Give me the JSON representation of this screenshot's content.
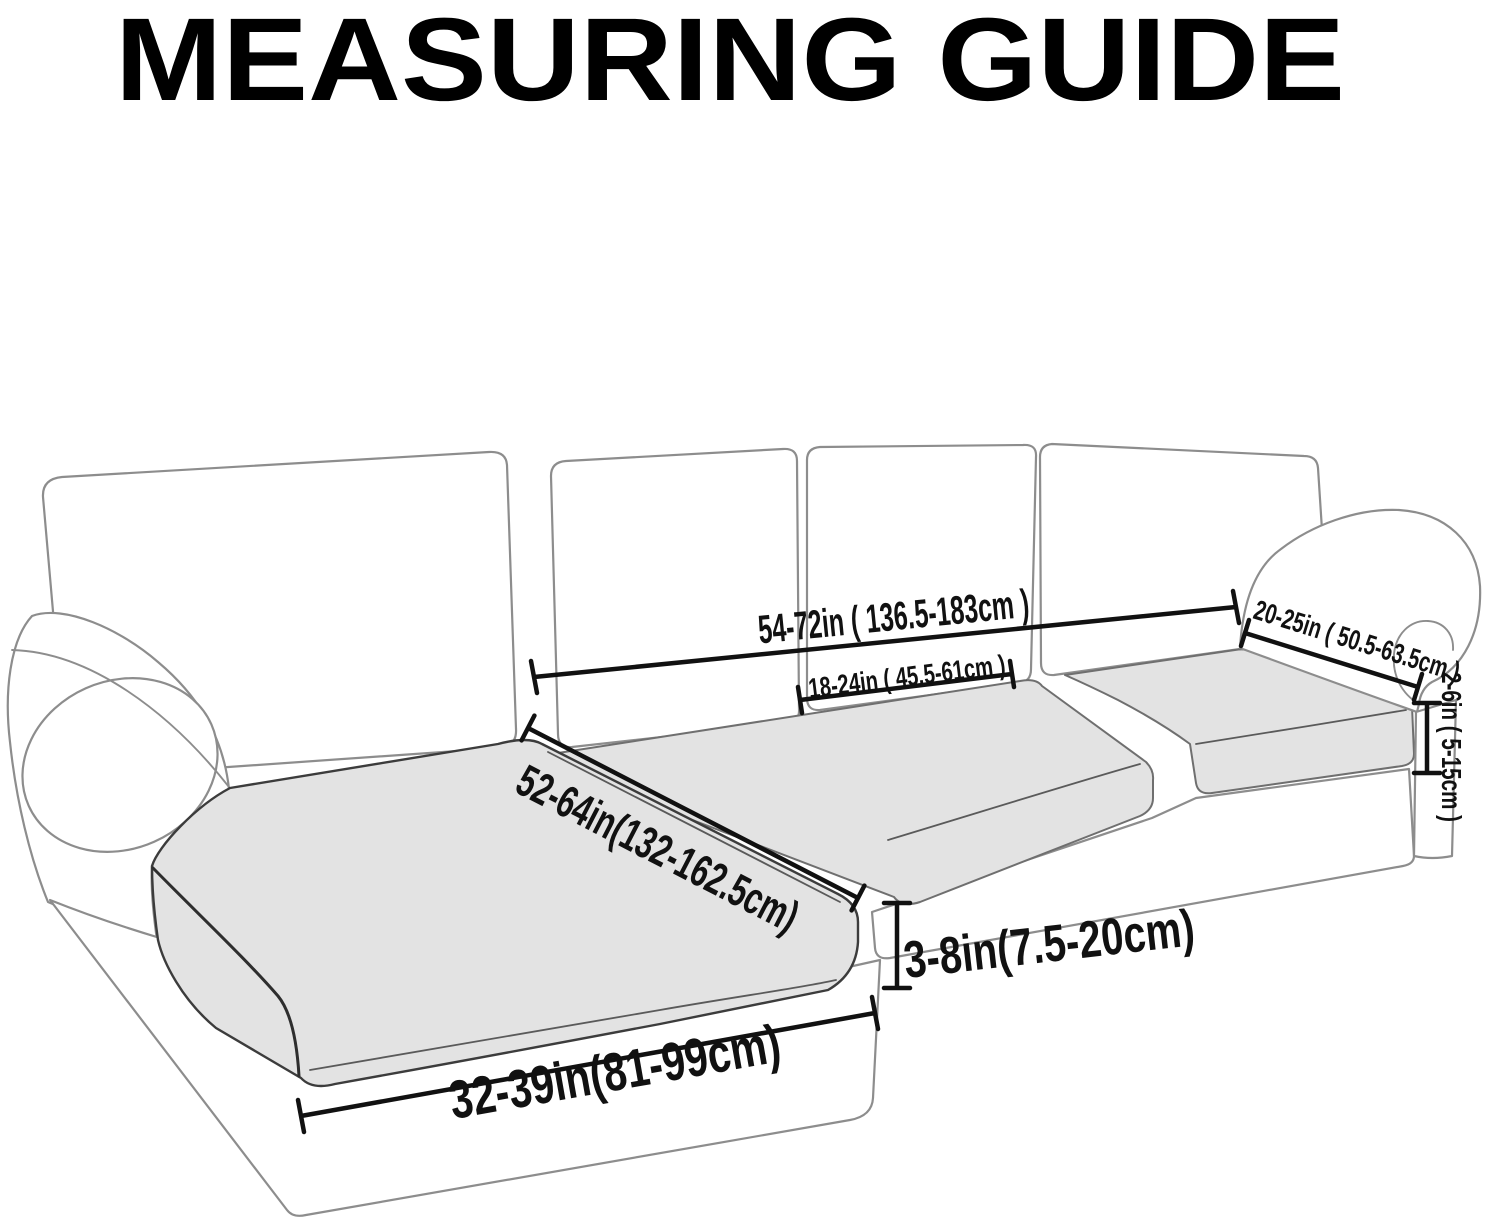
{
  "title": "MEASURING GUIDE",
  "colors": {
    "ink": "#111111",
    "outline": "#8d8d8d",
    "outline_dark": "#3c3c3c",
    "cushion_fill": "#e3e3e3",
    "background": "#ffffff"
  },
  "measurements": {
    "back_total_width": {
      "label": "54-72in ( 136.5-183cm )"
    },
    "back_cushion_width": {
      "label": "18-24in ( 45.5-61cm )"
    },
    "arm_length": {
      "label": "20-25in ( 50.5-63.5cm )"
    },
    "arm_to_seat_gap": {
      "label": "2-6in ( 5-15cm )"
    },
    "chaise_length": {
      "label": "52-64in(132-162.5cm)"
    },
    "seat_thickness": {
      "label": "3-8in(7.5-20cm)"
    },
    "chaise_width": {
      "label": "32-39in(81-99cm)"
    }
  }
}
